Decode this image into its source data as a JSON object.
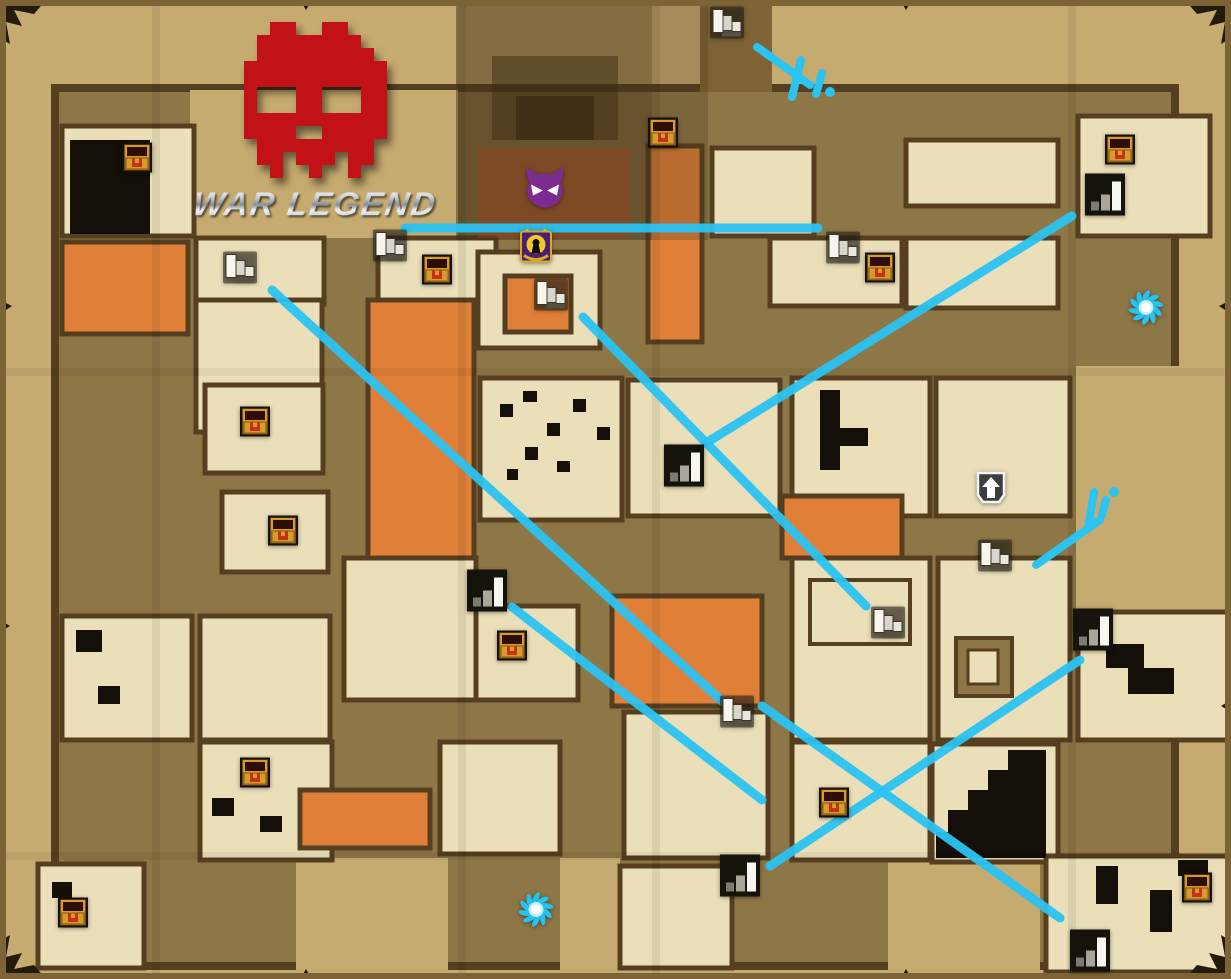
{
  "logo": {
    "title": "WAR LEGEND",
    "skull_color": "#c21217"
  },
  "colors": {
    "link_line": "#2bc3f2",
    "parchment": "#c6ab70",
    "corridor": "#8e7747",
    "room": "#ebdfb9",
    "lava": "#e08038",
    "wall": "#553f20",
    "dark_room": "#140f08"
  },
  "icons": {
    "chest": "treasure-chest-icon",
    "stairs_down": "stairs-down-icon",
    "stairs_up": "stairs-up-icon",
    "portal": "portal-icon",
    "demon": "demon-boss-icon",
    "lock": "locked-chest-icon",
    "arrow_up": "exit-arrow-up-icon"
  },
  "markers": [
    {
      "type": "chest",
      "x": 137,
      "y": 160
    },
    {
      "type": "chest",
      "x": 663,
      "y": 135
    },
    {
      "type": "chest",
      "x": 437,
      "y": 272
    },
    {
      "type": "chest",
      "x": 880,
      "y": 270
    },
    {
      "type": "chest",
      "x": 255,
      "y": 424
    },
    {
      "type": "chest",
      "x": 283,
      "y": 533
    },
    {
      "type": "chest",
      "x": 512,
      "y": 648
    },
    {
      "type": "chest",
      "x": 255,
      "y": 775
    },
    {
      "type": "chest",
      "x": 73,
      "y": 915
    },
    {
      "type": "chest",
      "x": 834,
      "y": 805
    },
    {
      "type": "chest",
      "x": 1120,
      "y": 152
    },
    {
      "type": "chest",
      "x": 1197,
      "y": 890
    },
    {
      "type": "stairs_down",
      "x": 727,
      "y": 25
    },
    {
      "type": "stairs_down",
      "x": 240,
      "y": 270
    },
    {
      "type": "stairs_down",
      "x": 390,
      "y": 248
    },
    {
      "type": "stairs_down",
      "x": 551,
      "y": 297
    },
    {
      "type": "stairs_down",
      "x": 843,
      "y": 250
    },
    {
      "type": "stairs_down",
      "x": 888,
      "y": 625
    },
    {
      "type": "stairs_down",
      "x": 995,
      "y": 558
    },
    {
      "type": "stairs_down",
      "x": 737,
      "y": 714
    },
    {
      "type": "stairs_up",
      "x": 1105,
      "y": 197
    },
    {
      "type": "stairs_up",
      "x": 684,
      "y": 468
    },
    {
      "type": "stairs_up",
      "x": 487,
      "y": 593
    },
    {
      "type": "stairs_up",
      "x": 1093,
      "y": 632
    },
    {
      "type": "stairs_up",
      "x": 740,
      "y": 878
    },
    {
      "type": "stairs_up",
      "x": 1090,
      "y": 953
    },
    {
      "type": "portal",
      "x": 1146,
      "y": 310
    },
    {
      "type": "portal",
      "x": 536,
      "y": 912
    },
    {
      "type": "demon",
      "x": 545,
      "y": 190
    },
    {
      "type": "lock",
      "x": 536,
      "y": 248
    },
    {
      "type": "arrow_up",
      "x": 991,
      "y": 490
    }
  ],
  "links": [
    {
      "x1": 405,
      "y1": 228,
      "x2": 818,
      "y2": 228
    },
    {
      "x1": 1072,
      "y1": 216,
      "x2": 706,
      "y2": 443
    },
    {
      "x1": 272,
      "y1": 290,
      "x2": 723,
      "y2": 702
    },
    {
      "x1": 583,
      "y1": 317,
      "x2": 866,
      "y2": 606
    },
    {
      "x1": 512,
      "y1": 607,
      "x2": 762,
      "y2": 800
    },
    {
      "x1": 770,
      "y1": 866,
      "x2": 1080,
      "y2": 660
    },
    {
      "x1": 762,
      "y1": 706,
      "x2": 1060,
      "y2": 918
    }
  ],
  "scribbles": [
    {
      "strokes": [
        [
          [
            757,
            47
          ],
          [
            810,
            85
          ]
        ],
        [
          [
            801,
            60
          ],
          [
            792,
            97
          ]
        ],
        [
          [
            822,
            73
          ],
          [
            816,
            94
          ]
        ]
      ],
      "dots": [
        [
          830,
          92
        ]
      ]
    },
    {
      "strokes": [
        [
          [
            1036,
            565
          ],
          [
            1100,
            520
          ]
        ],
        [
          [
            1094,
            492
          ],
          [
            1088,
            528
          ]
        ],
        [
          [
            1106,
            500
          ],
          [
            1102,
            515
          ]
        ]
      ],
      "dots": [
        [
          1114,
          492
        ]
      ]
    }
  ]
}
